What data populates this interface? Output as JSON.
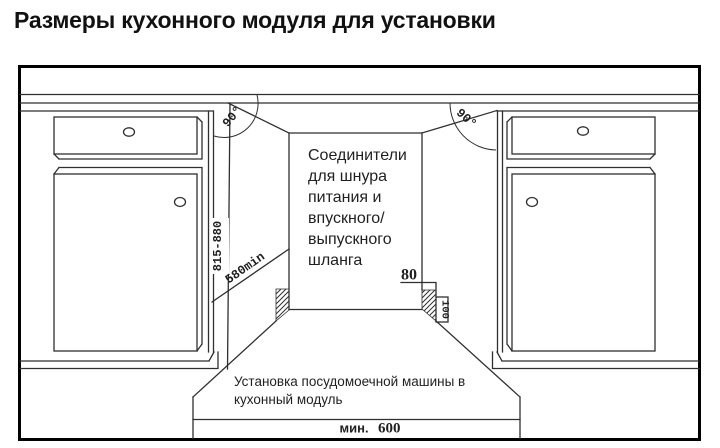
{
  "title": "Размеры кухонного модуля для установки",
  "niche_note": {
    "lines": [
      "Соединители",
      "для шнура",
      "питания и",
      "впускного/",
      "выпускного",
      "шланга"
    ]
  },
  "caption": {
    "lines": [
      "Установка посудомоечной машины в",
      "кухонный модуль"
    ]
  },
  "dimensions": {
    "height_range": "815-880",
    "depth_min": "580min",
    "hose_offset": "80",
    "hose_pocket_height": "100",
    "angle_left": "90°",
    "angle_right": "90°",
    "min_width_label": "мин.",
    "min_width_value": "600"
  },
  "colors": {
    "line": "#2f2f2f",
    "text": "#1f1f1f",
    "frame": "#000000"
  }
}
